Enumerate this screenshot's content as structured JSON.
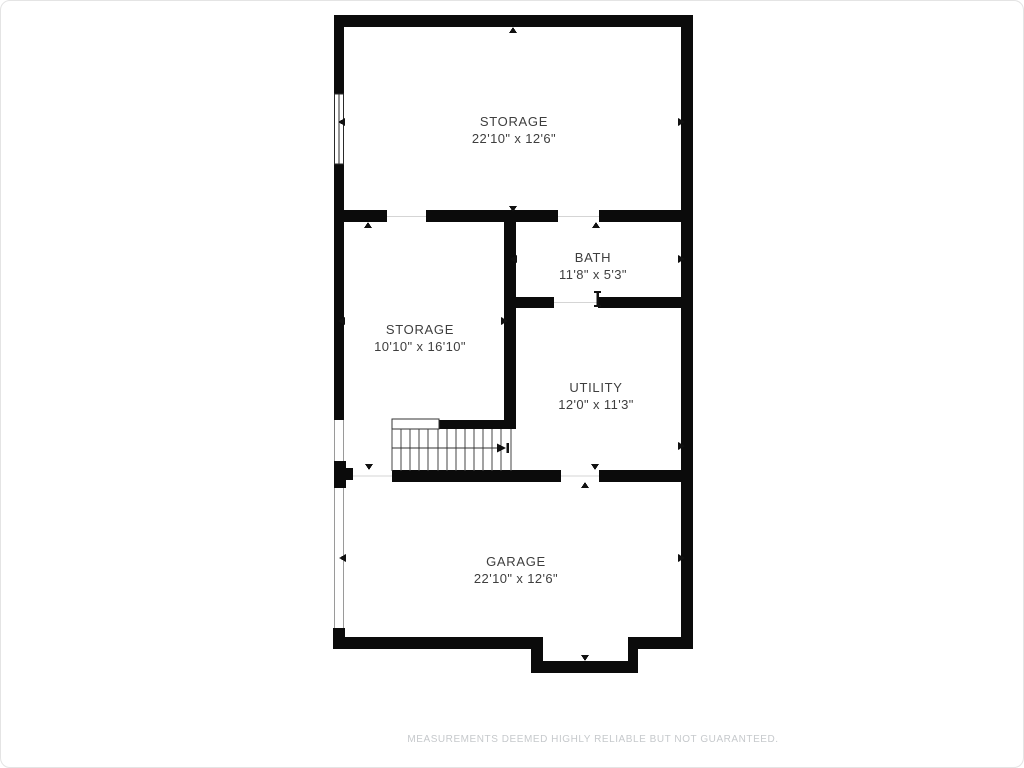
{
  "page": {
    "background": "#ffffff",
    "border_color": "#e4e4e4"
  },
  "plan": {
    "wall_color": "#0b0b0b",
    "label_color": "#3e3e3e",
    "rooms": [
      {
        "id": "storage-upper",
        "name": "STORAGE",
        "dimensions": "22'10\" x 12'6\""
      },
      {
        "id": "bath",
        "name": "BATH",
        "dimensions": "11'8\" x 5'3\""
      },
      {
        "id": "storage-middle",
        "name": "STORAGE",
        "dimensions": "10'10\" x 16'10\""
      },
      {
        "id": "utility",
        "name": "UTILITY",
        "dimensions": "12'0\" x 11'3\""
      },
      {
        "id": "garage",
        "name": "GARAGE",
        "dimensions": "22'10\" x 12'6\""
      }
    ]
  },
  "footer": {
    "disclaimer": "MEASUREMENTS DEEMED HIGHLY RELIABLE BUT NOT GUARANTEED.",
    "color": "#c6c9cc"
  }
}
